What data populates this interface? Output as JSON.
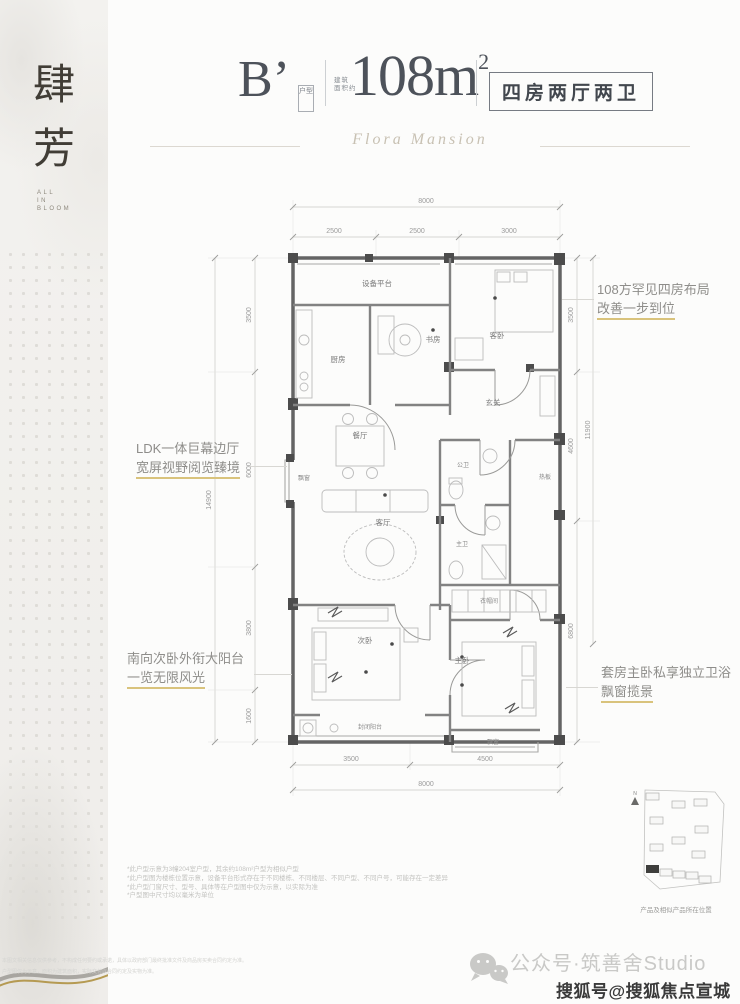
{
  "sidebar": {
    "char1": "肆",
    "char2": "芳",
    "tagline1": "ALL",
    "tagline2": "IN",
    "tagline3": "BLOOM"
  },
  "header": {
    "unit": "B’",
    "unit_tag": "户型",
    "area_prefix_line1": "建筑",
    "area_prefix_line2": "面积约",
    "area_number": "108m",
    "area_sup": "2",
    "layout_box": "四房两厅两卫",
    "script_title": "Flora Mansion"
  },
  "annotations": {
    "right_top": {
      "line1": "108方罕见四房布局",
      "line2": "改善一步到位"
    },
    "left_mid": {
      "line1": "LDK一体巨幕边厅",
      "line2": "宽屏视野阅览臻境"
    },
    "left_bottom": {
      "line1": "南向次卧外衔大阳台",
      "line2": "一览无限风光"
    },
    "right_bottom": {
      "line1": "套房主卧私享独立卫浴",
      "line2": "飘窗揽景"
    }
  },
  "plan": {
    "rooms": {
      "equipment": "设备平台",
      "kitchen": "厨房",
      "study": "书房",
      "guest_bedroom": "客卧",
      "foyer": "玄关",
      "dining": "餐厅",
      "bay_window_left": "飘窗",
      "living": "客厅",
      "public_bath": "公卫",
      "shelf": "热板",
      "master_bath": "主卫",
      "closet": "衣帽间",
      "second_bedroom": "次卧",
      "master_bedroom": "主卧",
      "enclosed_balcony": "封闭阳台",
      "bay_window_bottom": "飘窗"
    },
    "dims": {
      "top_total": "8000",
      "top_1": "2500",
      "top_2": "2500",
      "top_3": "3000",
      "left_total": "14900",
      "left_1": "3500",
      "left_2": "6000",
      "left_3": "3800",
      "left_4": "1600",
      "right_1": "3500",
      "right_2": "4600",
      "right_3": "6800",
      "right_total": "11900",
      "bottom_1": "3500",
      "bottom_2": "4500",
      "bottom_total": "8000"
    }
  },
  "notes": {
    "n1": "*此户型示意为3幢204室户型，其余约108m²户型为相似户型",
    "n2": "*此户型图为楼栋位置示意，设备平台形式存在于不同楼栋、不同楼层、不同户型、不同户号，可能存在一定差异",
    "n3": "*此户型门窗尺寸、型号、具体等在户型图中仅为示意，以实际为准",
    "n4": "*户型图中尺寸均以毫米为单位"
  },
  "sitemap": {
    "north_label": "N",
    "caption": "产品及相似产品所在位置"
  },
  "footer": {
    "tiny1": "本图文相关信息仅供参考，不构成任何要约或承诺，具体以政府部门最终批准文件及商品房买卖合同约定为准。",
    "tiny2": "户型图仅为示意，面积为建筑面积，实际交付以合同约定及实物为准。",
    "wechat": "公众号·筑善舍Studio",
    "sohu": "搜狐号@搜狐焦点宣城站"
  },
  "colors": {
    "accent_gold": "#d9c37c",
    "heading_gray": "#4d525a",
    "wall_gray": "#646464"
  }
}
